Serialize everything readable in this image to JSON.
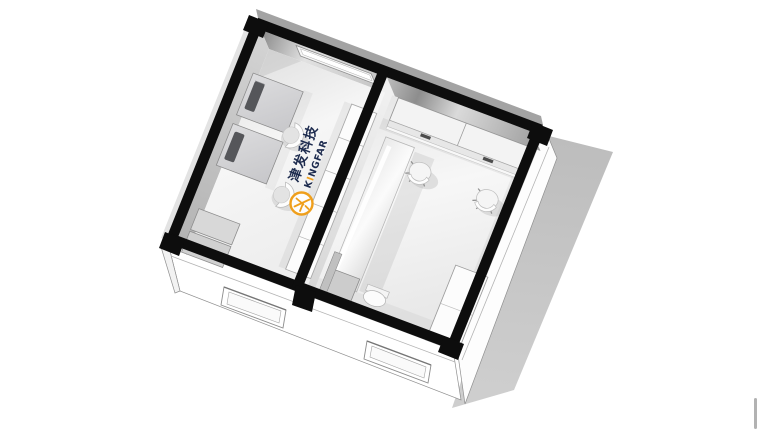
{
  "brand": {
    "chinese": "津发科技",
    "latin_k": "K",
    "latin_i": "I",
    "latin_rest": "NGFAR",
    "latin_full": "KINGFAR",
    "accent_orange": "#EF9F1C",
    "navy": "#1D2B4E"
  },
  "scene": {
    "type": "isometric-floorplan-cutaway-render",
    "wall_cut_color": "#0D0D0D",
    "ground_shadow_color": "#C8C8C8",
    "floor_color": "#F4F4F4",
    "rooms": [
      {
        "id": "left-office",
        "furniture": [
          "desk-with-monitor",
          "desk-with-monitor",
          "shell-chair",
          "shell-chair",
          "cabinet-row-5-segments",
          "low-cabinet",
          "low-cabinet",
          "recessed-light-slot",
          "floor-logo"
        ]
      },
      {
        "id": "right-office",
        "furniture": [
          "wall-cabinets-with-handles",
          "counter-band",
          "leaning-panel-table",
          "swivel-chair",
          "swivel-chair",
          "tall-cabinet",
          "side-cabinet",
          "slim-panel",
          "stool"
        ]
      }
    ],
    "south_wall_windows": 2,
    "scrollbar_fragment_visible": true
  }
}
